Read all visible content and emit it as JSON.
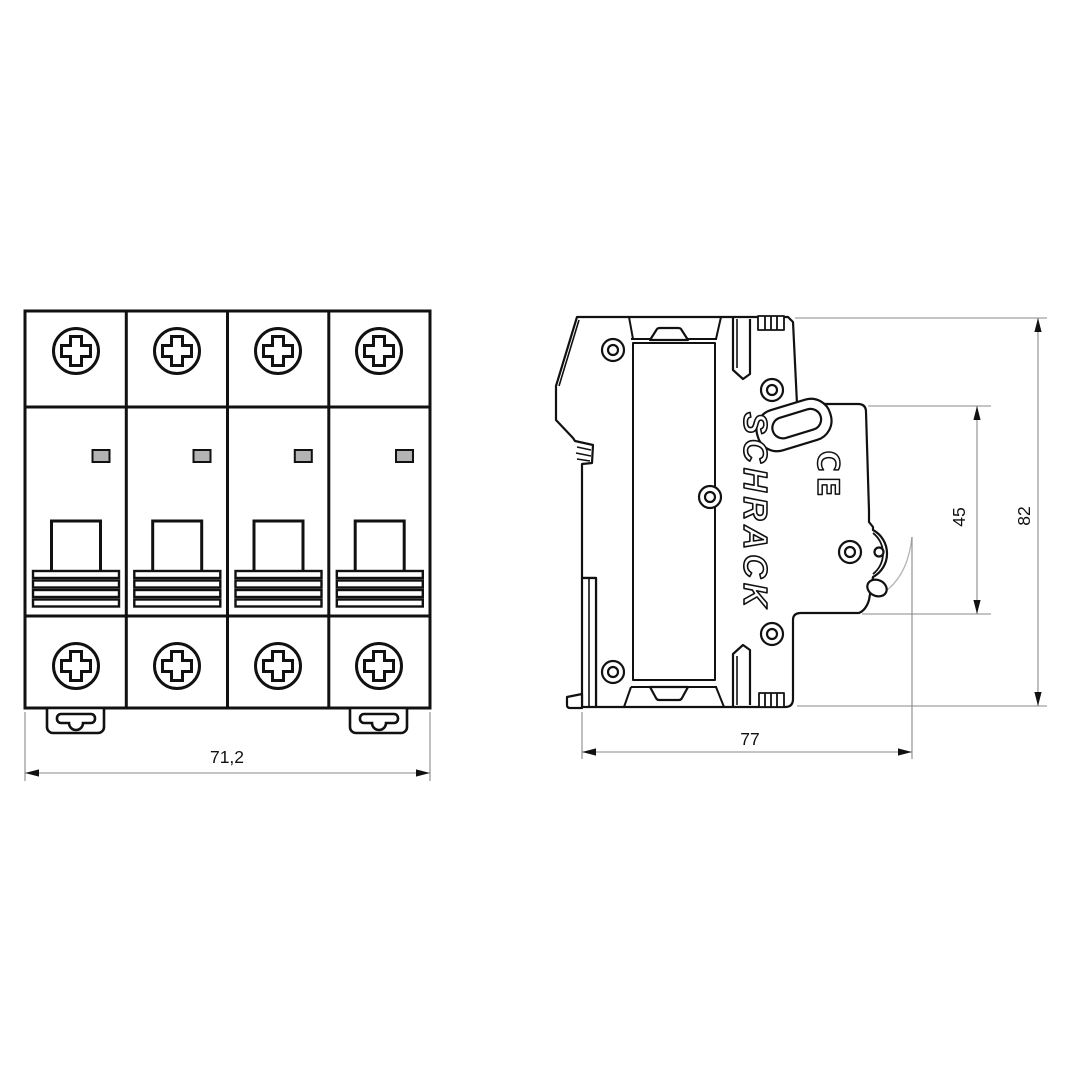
{
  "drawing": {
    "type": "technical dimension drawing of a 4-pole modular circuit breaker",
    "brand_label": "SCHRACK",
    "ce_label": "CE",
    "front_view": {
      "module_count": 4,
      "width_dim_label": "71,2"
    },
    "side_view": {
      "depth_dim_label": "77",
      "front_projection_dim_label": "45",
      "height_dim_label": "82"
    },
    "colors": {
      "line": "#111111",
      "dimension_line": "#8a8a8a",
      "indicator_fill": "#b3b3b3",
      "background": "#ffffff"
    }
  }
}
